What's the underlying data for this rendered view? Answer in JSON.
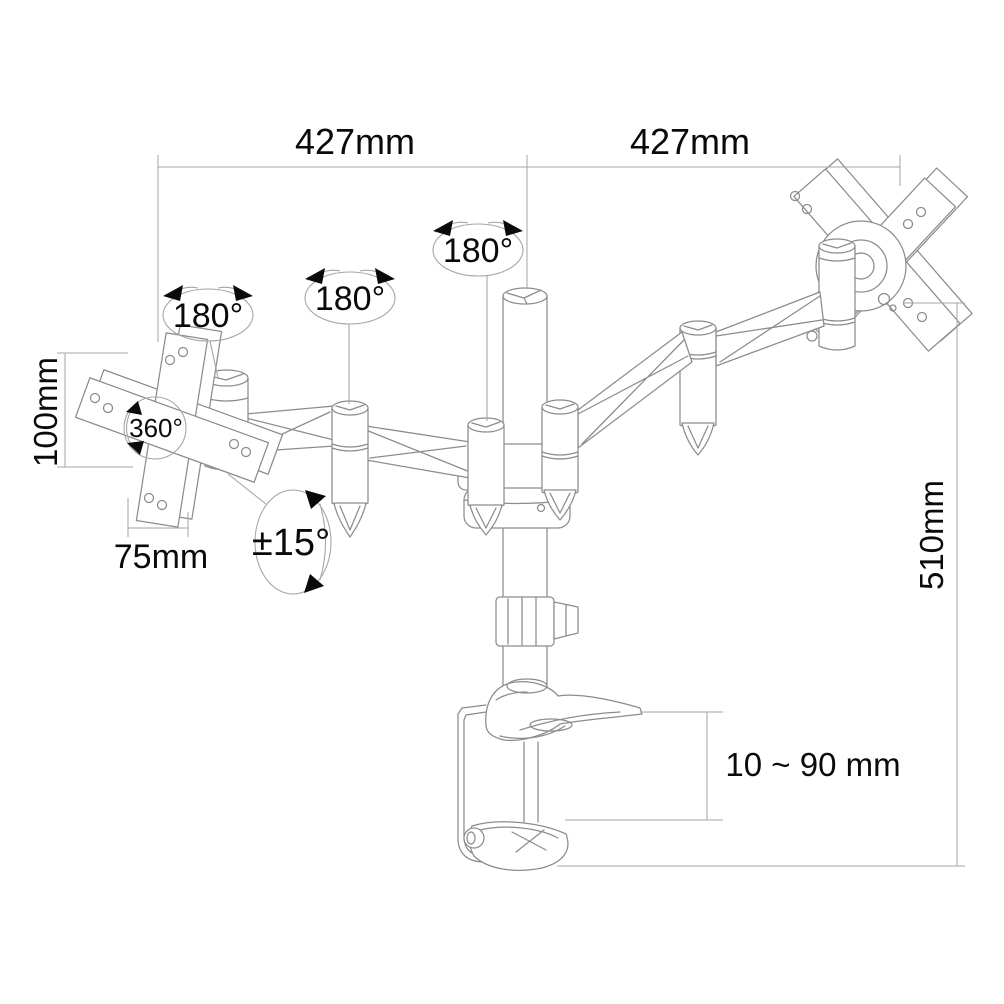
{
  "diagram": {
    "type": "technical-line-drawing",
    "subject": "dual-monitor-desk-mount-arm-dimensions",
    "colors": {
      "bg": "#ffffff",
      "line": "#8c8c8c",
      "dim": "#a6a6a6",
      "text": "#0a0a0a"
    },
    "labels": {
      "arm_reach_left": "427mm",
      "arm_reach_right": "427mm",
      "swivel_left_joint": "180°",
      "swivel_mid_joint": "180°",
      "swivel_pole_joint": "180°",
      "vesa_rotation": "360°",
      "tilt_range": "±15°",
      "vesa_height": "100mm",
      "vesa_width": "75mm",
      "pole_height": "510mm",
      "clamp_range": "10 ~ 90 mm"
    }
  }
}
